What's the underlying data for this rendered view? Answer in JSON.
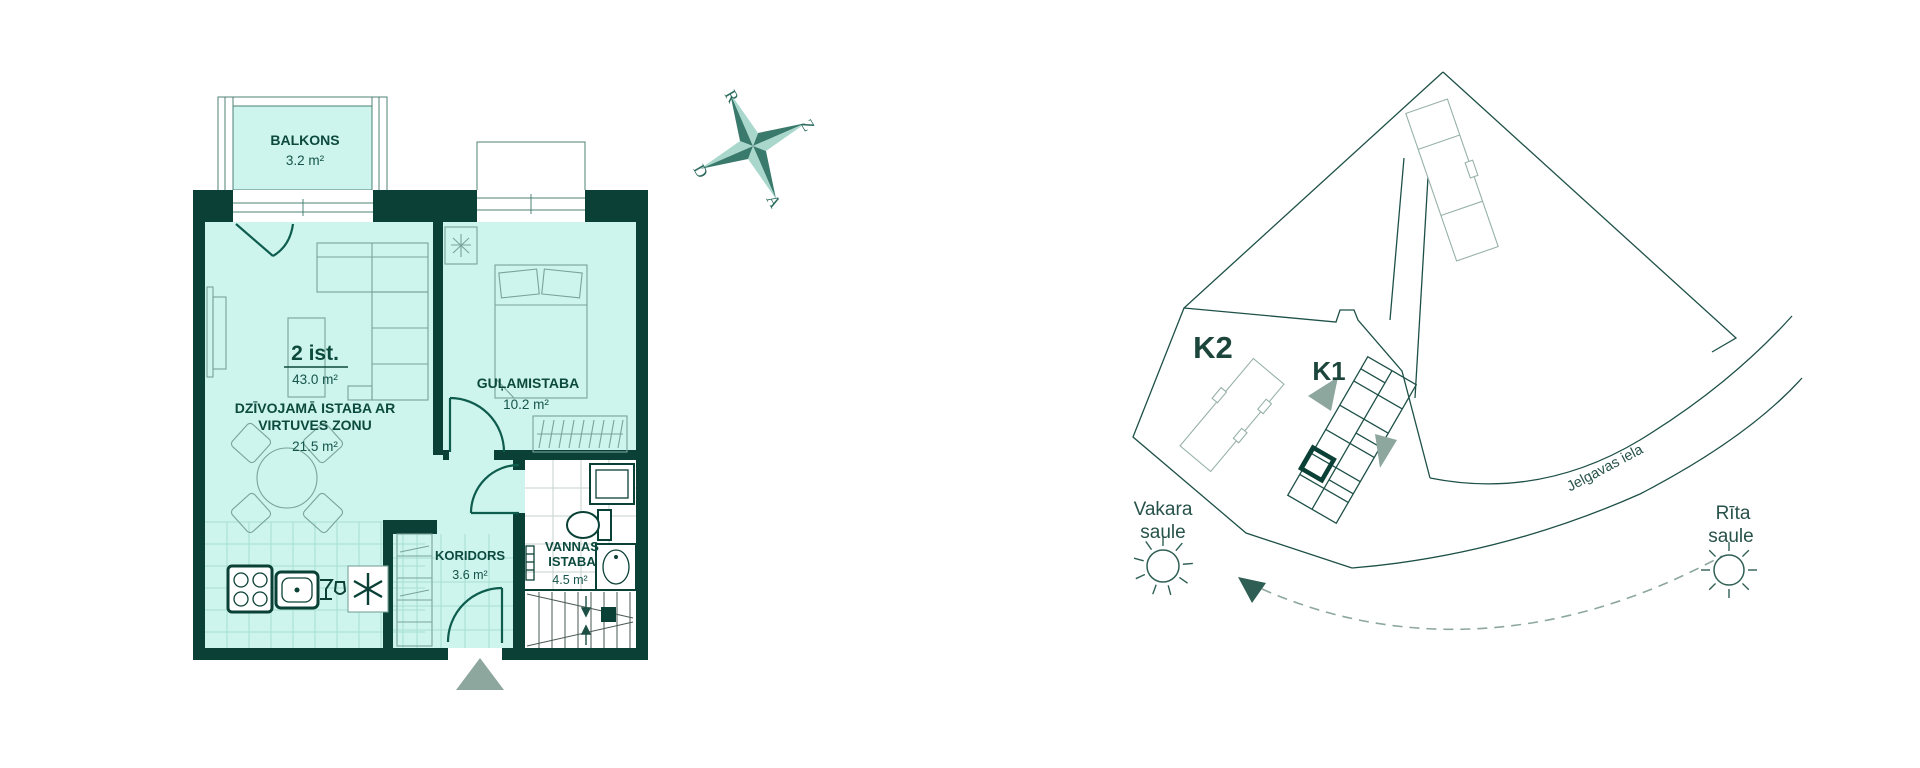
{
  "floor_plan": {
    "apartment_type": "2 ist.",
    "apartment_area": "43.0 m²",
    "rooms": {
      "balcony": {
        "name": "BALKONS",
        "area": "3.2 m²"
      },
      "living": {
        "name_line1": "DZĪVOJAMĀ ISTABA AR",
        "name_line2": "VIRTUVES ZONU",
        "area": "21.5 m²"
      },
      "bedroom": {
        "name": "GUĻAMISTABA",
        "area": "10.2 m²"
      },
      "corridor": {
        "name": "KORIDORS",
        "area": "3.6 m²"
      },
      "bathroom": {
        "name_line1": "VANNAS",
        "name_line2": "ISTABA",
        "area": "4.5 m²"
      }
    }
  },
  "compass": {
    "west": "R",
    "north": "Z",
    "south": "D",
    "east": "A"
  },
  "site_plan": {
    "building_k2": "K2",
    "building_k1": "K1",
    "evening_sun_line1": "Vakara",
    "evening_sun_line2": "saule",
    "morning_sun_line1": "Rīta",
    "morning_sun_line2": "saule",
    "street": "Jelgavas iela"
  },
  "colors": {
    "wall": "#0a4035",
    "room_fill": "#cdf4ed",
    "label_text": "#0d4a3e",
    "door_line": "#0d5c4e",
    "furniture_line": "#78a49a",
    "site_line": "#1d5047",
    "accent_gray": "#8da79f",
    "compass_dark": "#3a7a6d",
    "compass_light": "#a9d7cc"
  }
}
